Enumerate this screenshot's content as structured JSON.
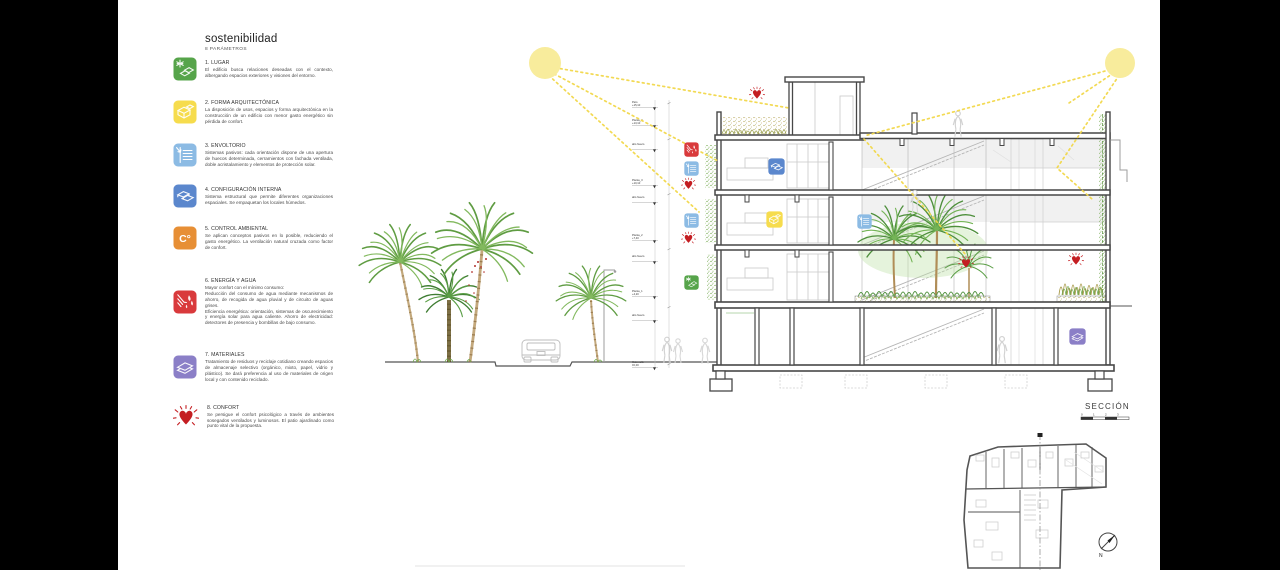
{
  "header": {
    "title": "sostenibilidad",
    "subtitle": "8 PARÁMETROS"
  },
  "parameters": [
    {
      "heading": "1. LUGAR",
      "color": "#56a44a",
      "desc": "El edificio busca relaciones deseadas con el contexto, albergando espacios exteriores y visiones del entorno."
    },
    {
      "heading": "2. FORMA ARQUITECTÓNICA",
      "color": "#f6dc4d",
      "desc": "La disposición de usos, espacios y forma arquitectónica en la construcción de un edificio con menor gasto energético sin pérdida de confort."
    },
    {
      "heading": "3. ENVOLTORIO",
      "color": "#8cbbe4",
      "desc": "Sistemas pasivos: cada orientación dispone de una apertura de huecos determinada, cerramientos con fachada ventilada, doble acristalamiento y elementos de protección solar."
    },
    {
      "heading": "4. CONFIGURACIÓN INTERNA",
      "color": "#5b87cd",
      "desc": "Sistema estructural que permite diferentes organizaciones espaciales. Se empaquetan los locales húmedos."
    },
    {
      "heading": "5. CONTROL AMBIENTAL",
      "color": "#e78f35",
      "desc": "Se aplican conceptos pasivos en lo posible, reduciendo el gasto energético. La ventilación natural cruzada como factor de confort."
    },
    {
      "heading": "6. ENERGÍA Y AGUA",
      "color": "#d93a3c",
      "desc": "Mayor confort con el mínimo consumo:\nReducción del consumo de agua mediante mecanismos de ahorro, de recogida de agua pluvial y de circuito de aguas grises.\nEficiencia energética: orientación, sistemas de oscurecimiento y energía solar para agua caliente. Ahorro de electricidad: detectores de presencia y bombillas de bajo consumo."
    },
    {
      "heading": "7. MATERIALES",
      "color": "#8b7fc7",
      "desc": "Tratamiento de residuos y reciclaje cotidiano creando espacios de almacenaje selectivo (orgánico, mixto, papel, vidrio y plástico). Se dará preferencia al uso de materiales de origen local y con contenido reciclado."
    },
    {
      "heading": "8. CONFORT",
      "color": "#c41e22",
      "desc": "Se persigue el confort psicológico a través de ambientes sosegados ventilados y luminosos. El patio ajardinado como punto vital de la propuesta."
    }
  ],
  "section": {
    "label": "SECCIÓN",
    "scale_ticks": [
      "0",
      "1",
      "2",
      "3"
    ],
    "north_label": "N",
    "control_glyph": "C°",
    "levels": [
      {
        "name": "Peto",
        "elev": "+15,10"
      },
      {
        "name": "Planta_4",
        "elev": "+13,10"
      },
      {
        "name": "alto hueco",
        "elev": ""
      },
      {
        "name": "Planta_3",
        "elev": "+10,10"
      },
      {
        "name": "alto hueco",
        "elev": ""
      },
      {
        "name": "Planta_2",
        "elev": "+7,40"
      },
      {
        "name": "alto hueco",
        "elev": ""
      },
      {
        "name": "Planta_1",
        "elev": "+4,20"
      },
      {
        "name": "alto hueco",
        "elev": ""
      },
      {
        "name": "Cota calle",
        "elev": "±0,00"
      }
    ],
    "colors": {
      "sun": "#f8ec9c",
      "ray": "#f2d84a",
      "heart": "#c41e22",
      "wall": "#474747"
    }
  }
}
